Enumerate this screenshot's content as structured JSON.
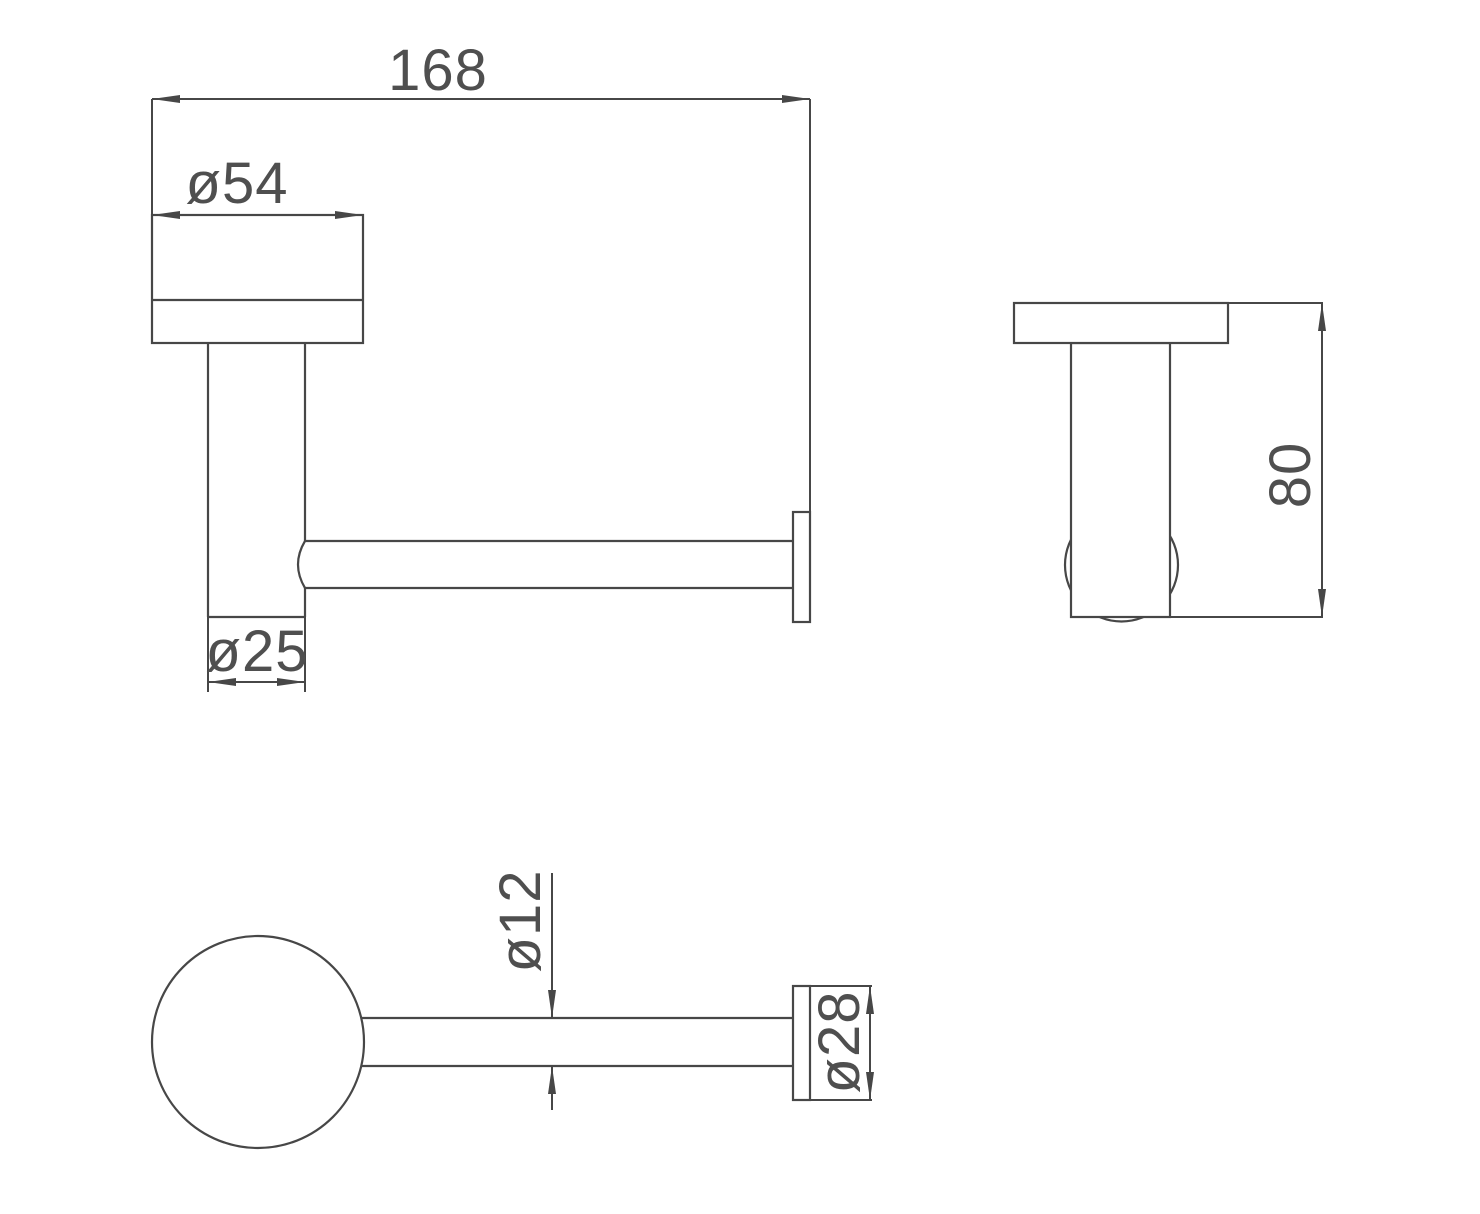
{
  "colors": {
    "background": "#ffffff",
    "line": "#474747",
    "text": "#4f4f4f"
  },
  "dimensions": {
    "front_view": {
      "overall_length": "168",
      "flange_diameter": "ø54",
      "post_diameter": "ø25"
    },
    "side_view": {
      "depth": "80"
    },
    "bottom_view": {
      "bar_diameter": "ø12",
      "end_cap_diameter": "ø28"
    }
  }
}
